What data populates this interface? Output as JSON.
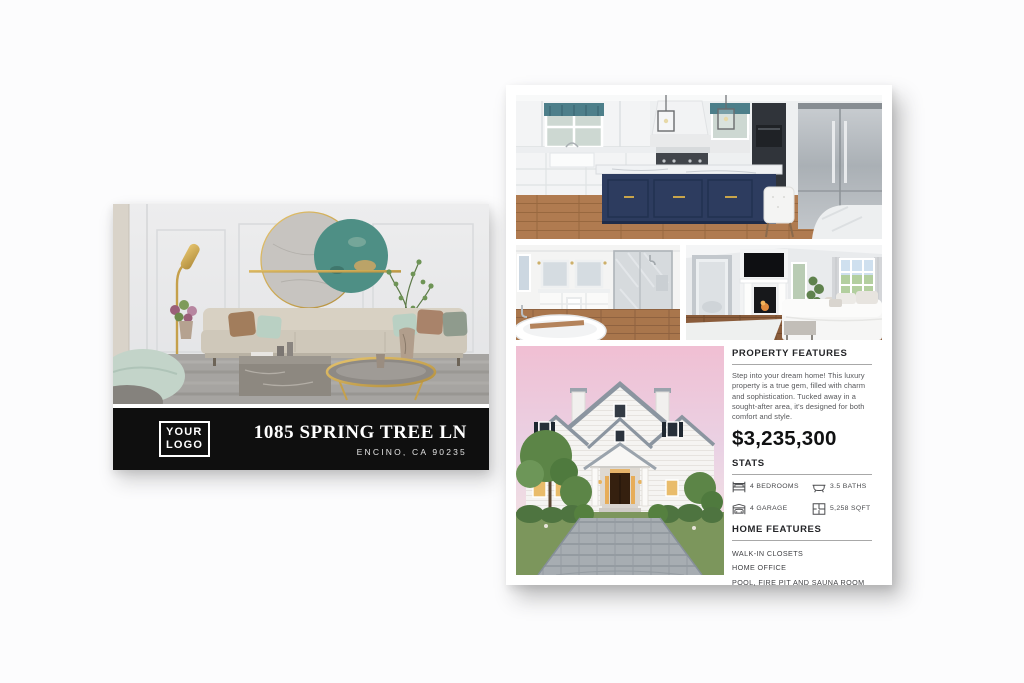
{
  "postcard": {
    "logo": {
      "line1": "YOUR",
      "line2": "LOGO"
    },
    "address": "1085 SPRING TREE LN",
    "city": "ENCINO, CA 90235",
    "photo": "living-room"
  },
  "flyer": {
    "photos": [
      "kitchen",
      "bathroom",
      "bedroom",
      "exterior-sunset"
    ],
    "property_features": {
      "title": "PROPERTY FEATURES",
      "description": "Step into your dream home! This luxury property is a true gem, filled with charm and sophistication. Tucked away in a sought-after area, it's designed for both comfort and style.",
      "price": "$3,235,300"
    },
    "stats": {
      "title": "STATS",
      "items": [
        {
          "icon": "bed-icon",
          "label": "4 BEDROOMS"
        },
        {
          "icon": "bath-icon",
          "label": "3.5 BATHS"
        },
        {
          "icon": "garage-icon",
          "label": "4 GARAGE"
        },
        {
          "icon": "floorplan-icon",
          "label": "5,258 SQFT"
        }
      ]
    },
    "home_features": {
      "title": "HOME FEATURES",
      "items": [
        "WALK-IN CLOSETS",
        "HOME OFFICE",
        "POOL, FIRE PIT AND SAUNA ROOM"
      ]
    }
  },
  "colors": {
    "postcard_bar": "#0f0f0f",
    "flyer_background": "#ffffff",
    "heading_text": "#242528",
    "price_text": "#101112",
    "island_navy": "#2d3c5f",
    "sunset_pink": "#f0bfd3",
    "accent_gold": "#c9a54a"
  }
}
